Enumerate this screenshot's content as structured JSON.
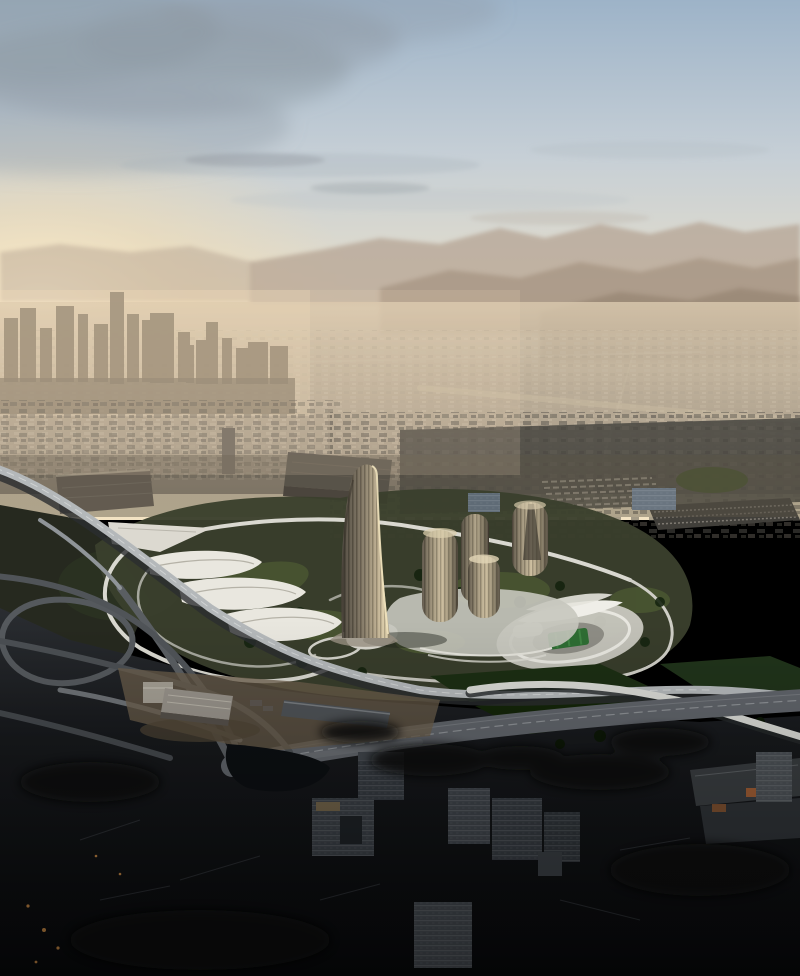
{
  "scene": {
    "kind": "aerial-architectural-render",
    "visible_text": []
  },
  "palette": {
    "sky_top": "#9db3c8",
    "sky_mid": "#c6cfd6",
    "sky_cream": "#e8dfca",
    "sky_horizon": "#f3e3c3",
    "sun_glow": "#fff3d6",
    "warm_glow": "#f9dfae",
    "cloud_grey": "#8e99a2",
    "mountain_far": "#b3a191",
    "mountain_mid": "#a08e7c",
    "mountain_near": "#8d7c69",
    "valley_light": "#d6c5ab",
    "valley_dark": "#8f8475",
    "haze_warm": "#f0dcb9",
    "skyline_silhouette": "#75695a",
    "sprawl_dark": "#474540",
    "site_ground": "#3a3f2d",
    "site_grass": "#4e5c33",
    "tree_dark": "#15230f",
    "park_green": "#42502a",
    "road_white": "#d9d8d0",
    "viaduct_deck": "#b4b8ba",
    "ramp_white": "#d9dad5",
    "highway_grey": "#60646a",
    "canopy_white": "#e9e7df",
    "stadium_plaza": "#c9c8c0",
    "stadium_roof": "#efeee8",
    "pitch_green": "#2e6d33",
    "tower_shade": "#4a443a",
    "tower_body": "#857a66",
    "tower_light": "#b9aa8c",
    "tower_edge": "#f0e2bd",
    "cyl_edge": "#5d5547",
    "cyl_body": "#a2967c",
    "cyl_light": "#ccbd9d",
    "slab_blue": "#5f6b76",
    "foreground_top": "#2a2d31",
    "foreground_black": "#07080a",
    "sand_ground": "#6b5e4b",
    "warehouse_lit": "#a39e93",
    "warehouse_dark": "#4e5256",
    "apartment_grey": "#383d43",
    "orange_wall": "#a85f33",
    "water_dark": "#0c0f12",
    "field_green": "#1c2e13"
  }
}
